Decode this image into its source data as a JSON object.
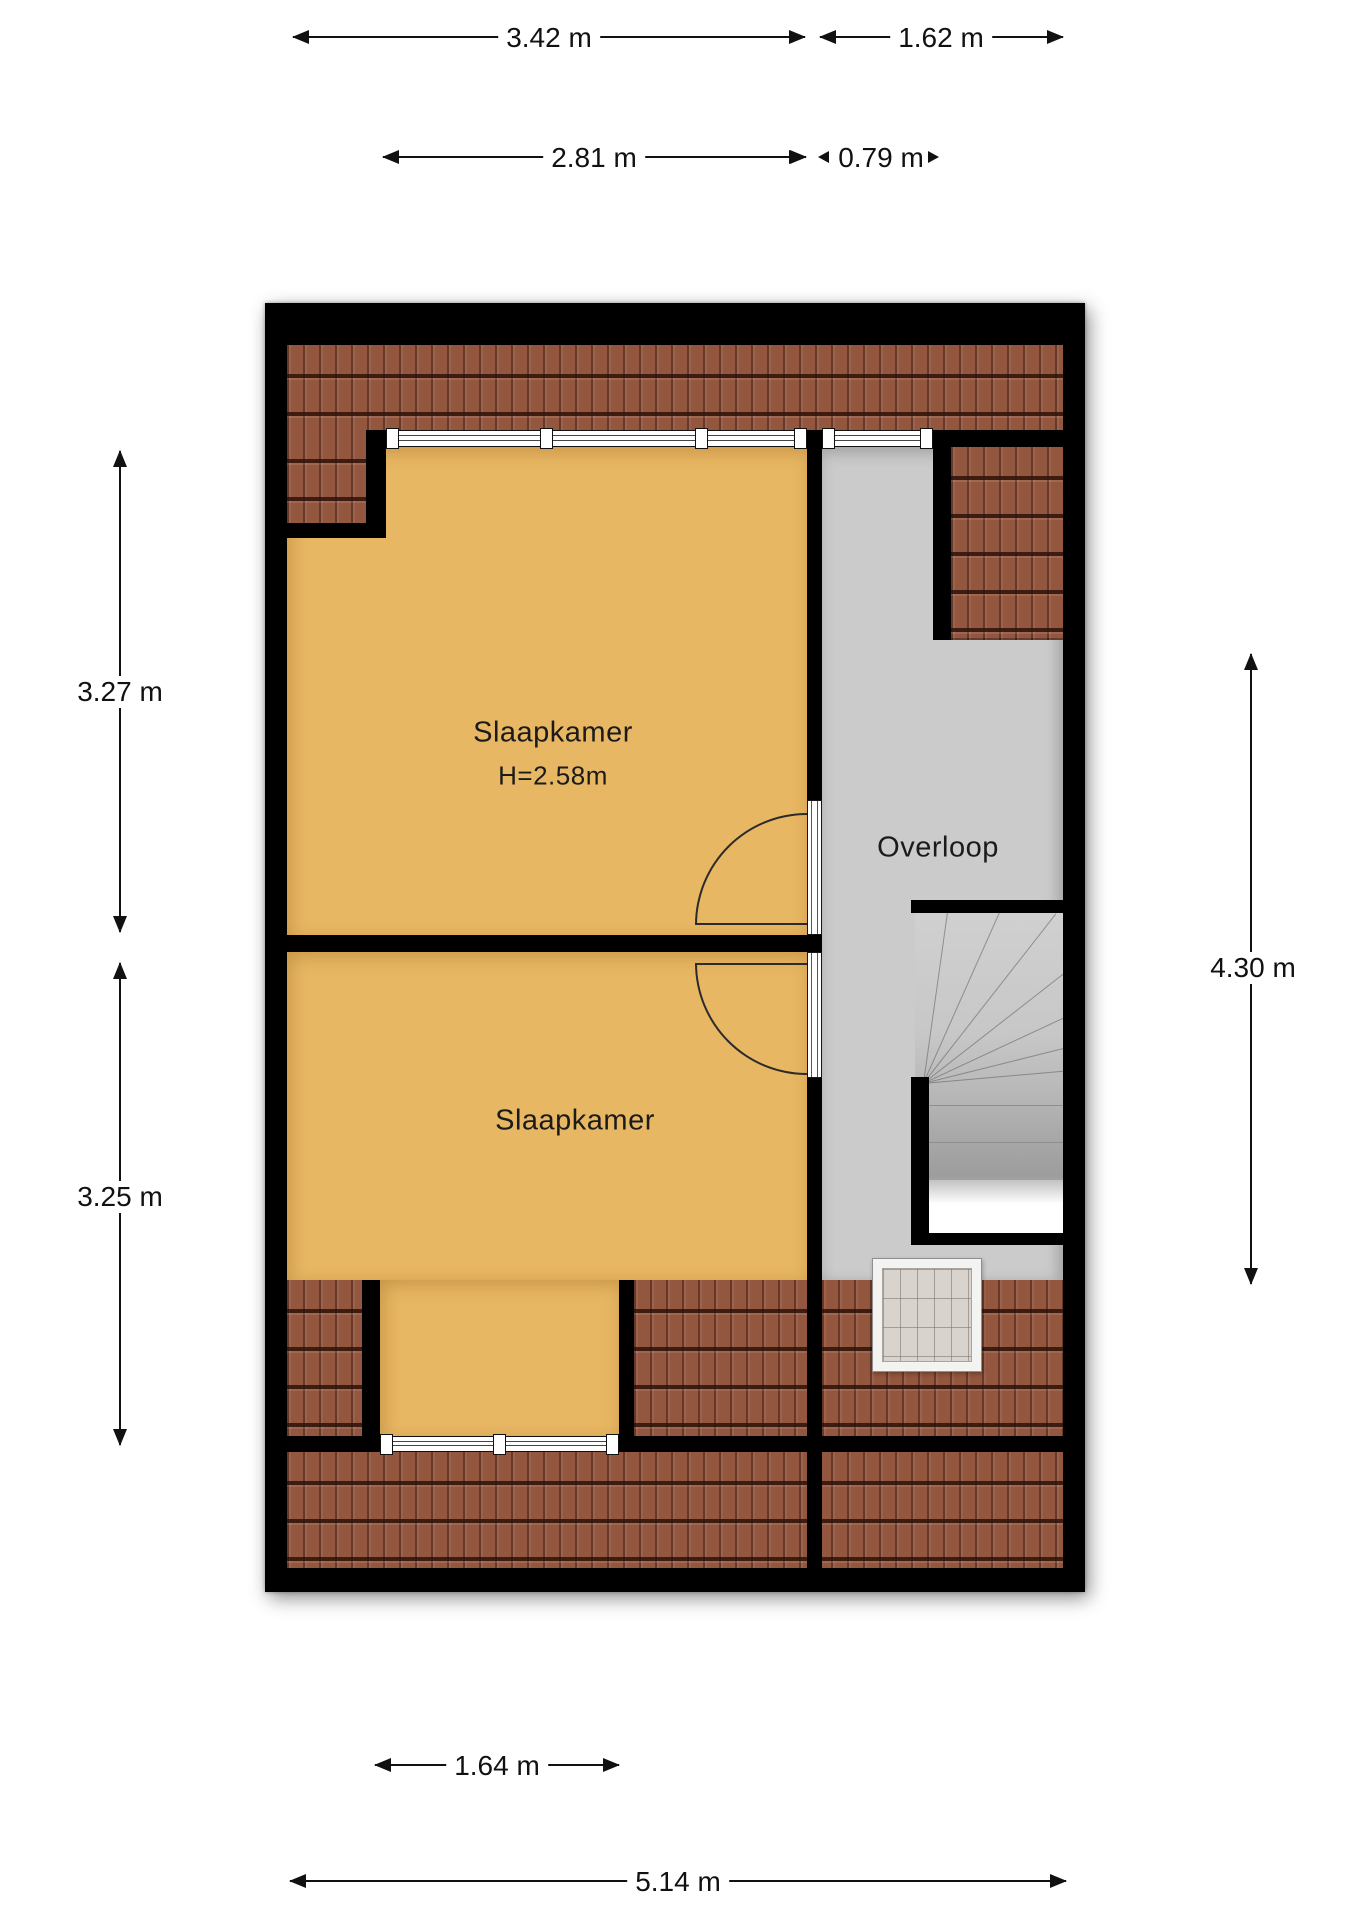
{
  "plan": {
    "rooms": {
      "bedroom_top": {
        "label": "Slaapkamer",
        "height_label": "H=2.58m"
      },
      "bedroom_bottom": {
        "label": "Slaapkamer"
      },
      "landing": {
        "label": "Overloop"
      }
    },
    "dimensions": {
      "top_width_bedroom": "3.42 m",
      "top_width_landing": "1.62 m",
      "window_width_bedroom": "2.81 m",
      "window_width_landing": "0.79 m",
      "left_height_bedroom_top": "3.27 m",
      "left_height_bedroom_bottom": "3.25 m",
      "right_height_landing": "4.30 m",
      "bottom_window_width": "1.64 m",
      "total_width": "5.14 m"
    },
    "colors": {
      "wall": "#000000",
      "bedroom_floor": "#e8b763",
      "landing_floor": "#cbcbcb",
      "roof_tiles": "#93563f",
      "dimension_text": "#111111"
    }
  }
}
